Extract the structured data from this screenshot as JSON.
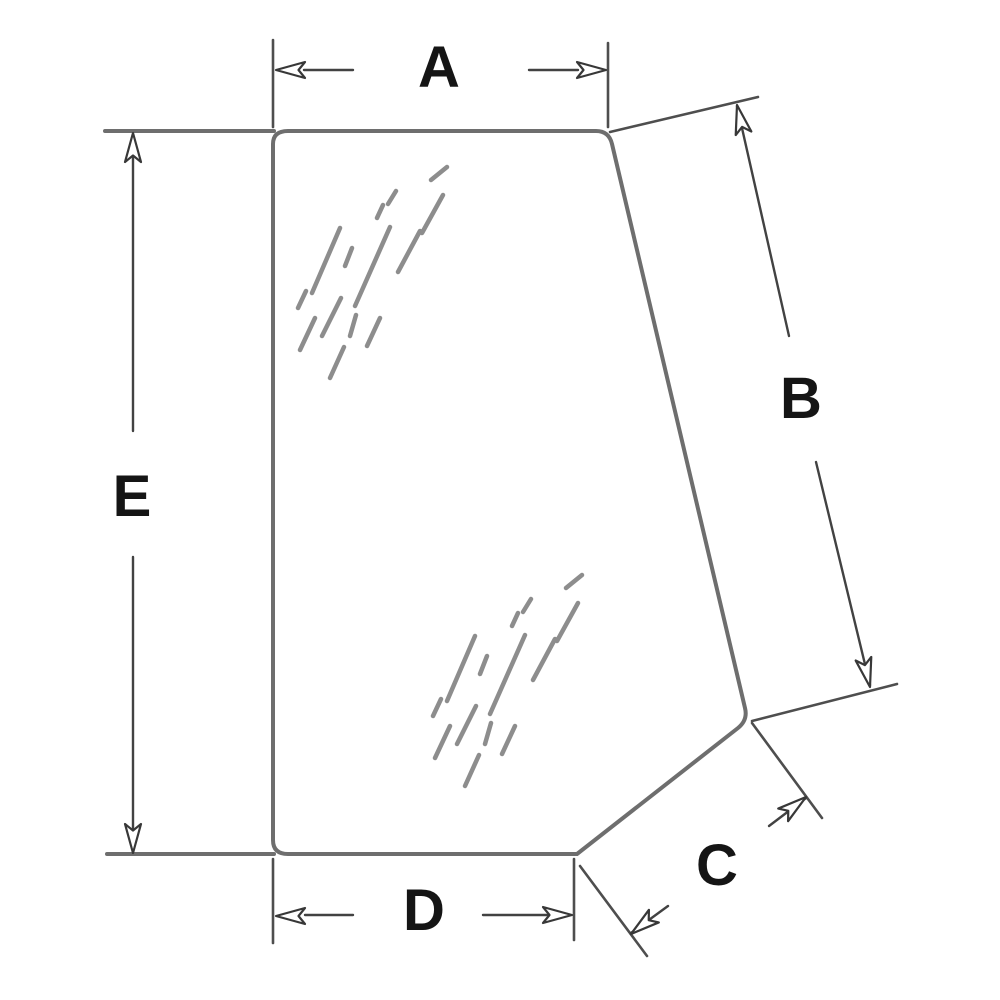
{
  "diagram": {
    "kind": "technical-dimension-drawing",
    "subject": "glass-panel-outline",
    "background_color": "#ffffff",
    "outline_color": "#6e6e6e",
    "extension_line_color": "#4e4e4e",
    "dimension_line_color": "#424242",
    "shine_mark_color": "#8d8d8d",
    "label_color": "#151515",
    "dimension_labels": {
      "a": "A",
      "b": "B",
      "c": "C",
      "d": "D",
      "e": "E"
    }
  }
}
